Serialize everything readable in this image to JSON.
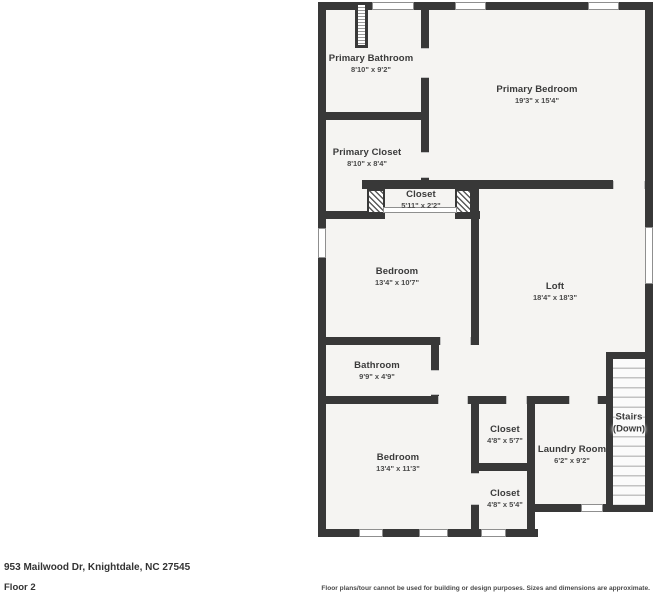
{
  "address": "953 Mailwood Dr, Knightdale, NC 27545",
  "floor_label": "Floor 2",
  "disclaimer": "Floor plans/tour cannot be used for building or design purposes. Sizes and dimensions are approximate.",
  "colors": {
    "wall": "#383838",
    "floor": "#f5f4f2",
    "text": "#3a3a3a"
  },
  "rooms": [
    {
      "name": "Primary Bathroom",
      "dims": "8'10\" x 9'2\"",
      "x": 371,
      "y": 64,
      "variant": ""
    },
    {
      "name": "Primary Bedroom",
      "dims": "19'3\" x 15'4\"",
      "x": 537,
      "y": 95,
      "variant": ""
    },
    {
      "name": "Primary Closet",
      "dims": "8'10\" x 8'4\"",
      "x": 367,
      "y": 158,
      "variant": ""
    },
    {
      "name": "Closet",
      "dims": "5'11\" x 2'2\"",
      "x": 421,
      "y": 200,
      "variant": ""
    },
    {
      "name": "Bedroom",
      "dims": "13'4\" x 10'7\"",
      "x": 397,
      "y": 277,
      "variant": ""
    },
    {
      "name": "Loft",
      "dims": "18'4\" x 18'3\"",
      "x": 555,
      "y": 292,
      "variant": ""
    },
    {
      "name": "Bathroom",
      "dims": "9'9\" x 4'9\"",
      "x": 377,
      "y": 371,
      "variant": ""
    },
    {
      "name": "Closet",
      "dims": "4'8\" x 5'7\"",
      "x": 505,
      "y": 435,
      "variant": ""
    },
    {
      "name": "Laundry Room",
      "dims": "6'2\" x 9'2\"",
      "x": 572,
      "y": 455,
      "variant": ""
    },
    {
      "name": "Bedroom",
      "dims": "13'4\" x 11'3\"",
      "x": 398,
      "y": 463,
      "variant": ""
    },
    {
      "name": "Closet",
      "dims": "4'8\" x 5'4\"",
      "x": 505,
      "y": 499,
      "variant": ""
    },
    {
      "name": "Stairs",
      "dims": "(Down)",
      "x": 629,
      "y": 424,
      "variant": "stairs"
    }
  ]
}
